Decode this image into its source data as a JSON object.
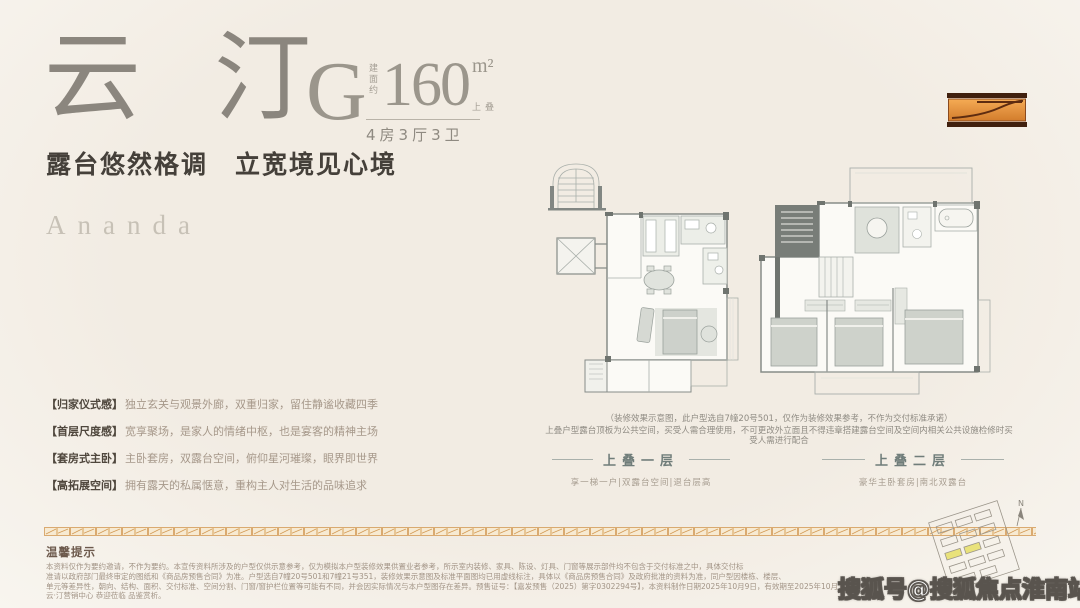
{
  "header": {
    "title": "云汀",
    "type_letter": "G",
    "area_label_vertical": "建面约",
    "area_value": "160",
    "area_unit": "m²",
    "area_tag": "上叠",
    "layout": "4房3厅3卫",
    "subtitle": "露台悠然格调　立宽境见心境"
  },
  "brand": "Ananda",
  "features": [
    {
      "head": "【归家仪式感】",
      "text": "独立玄关与观景外廊，双重归家，留住静谧收藏四季"
    },
    {
      "head": "【首层尺度感】",
      "text": "宽享聚场，是家人的情绪中枢，也是宴客的精神主场"
    },
    {
      "head": "【套房式主卧】",
      "text": "主卧套房，双露台空间，俯仰星河璀璨，眼界即世界"
    },
    {
      "head": "【高拓展空间】",
      "text": "拥有露天的私属惬意，重构主人对生活的品味追求"
    }
  ],
  "plans": {
    "note_line1": "（装修效果示意图，此户型选自7幢20号501，仅作为装修效果参考，不作为交付标准承诺）",
    "note_line2": "上叠户型露台顶板为公共空间，买受人需合理使用，不可更改外立面且不得违章搭建露台空间及空间内相关公共设施检修时买受人需进行配合",
    "items": [
      {
        "label": "上叠一层",
        "caption": "享一梯一户|双露台空间|退台层高"
      },
      {
        "label": "上叠二层",
        "caption": "豪华主卧套房|南北双露台"
      }
    ]
  },
  "minimap": {
    "compass": "N"
  },
  "footer": {
    "warm_title": "温馨提示",
    "lines": [
      "本资料仅作为要约邀请，不作为要约。本宣传资料所涉及的户型仅供示意参考，仅为模拟本户型装修效果供置业者参考，所示室内装修、家具、陈设、灯具、门窗等展示部件均不包含于交付标准之中，具体交付标",
      "准请以政府部门最终审定的图纸和《商品房预售合同》为准。户型选自7幢20号501和7幢21号351，装修效果示意图及标准平面图均已用虚线标注，具体以《商品房预售合同》及政府批准的资料为准，同户型因楼栋、楼层、",
      "单元等差异性，朝向、结构、面积、交付标准、空间分割、门窗/窗护栏位置等可能有不同，并会因实际情况与本户型图存在差异。预售证号：【嘉发预售（2025）第字0302294号】，本资料制作日期2025年10月9日，有效期至2025年10月15日，",
      "云·汀营销中心 恭迎莅临 品鉴赏析。"
    ]
  },
  "watermark": "搜狐号@搜狐焦点淮南站",
  "colors": {
    "background": "#f3efe8",
    "title": "#8b867e",
    "subtitle": "#45403a",
    "brand": "#c8c2b8",
    "feature_head": "#4f473d",
    "feature_text": "#a6988a",
    "plan_line": "#9aa19d",
    "plan_wall": "#828783",
    "plan_label": "#707d7a",
    "strip_orange": "#d39a55",
    "logo_orange": "#e0873a",
    "logo_dark": "#40200e",
    "warm_title": "#6c594c",
    "disclaimer": "#a29486",
    "watermark_fill": "#ffffff",
    "watermark_stroke": "#59544e",
    "minimap_highlight": "#e9e27b"
  }
}
